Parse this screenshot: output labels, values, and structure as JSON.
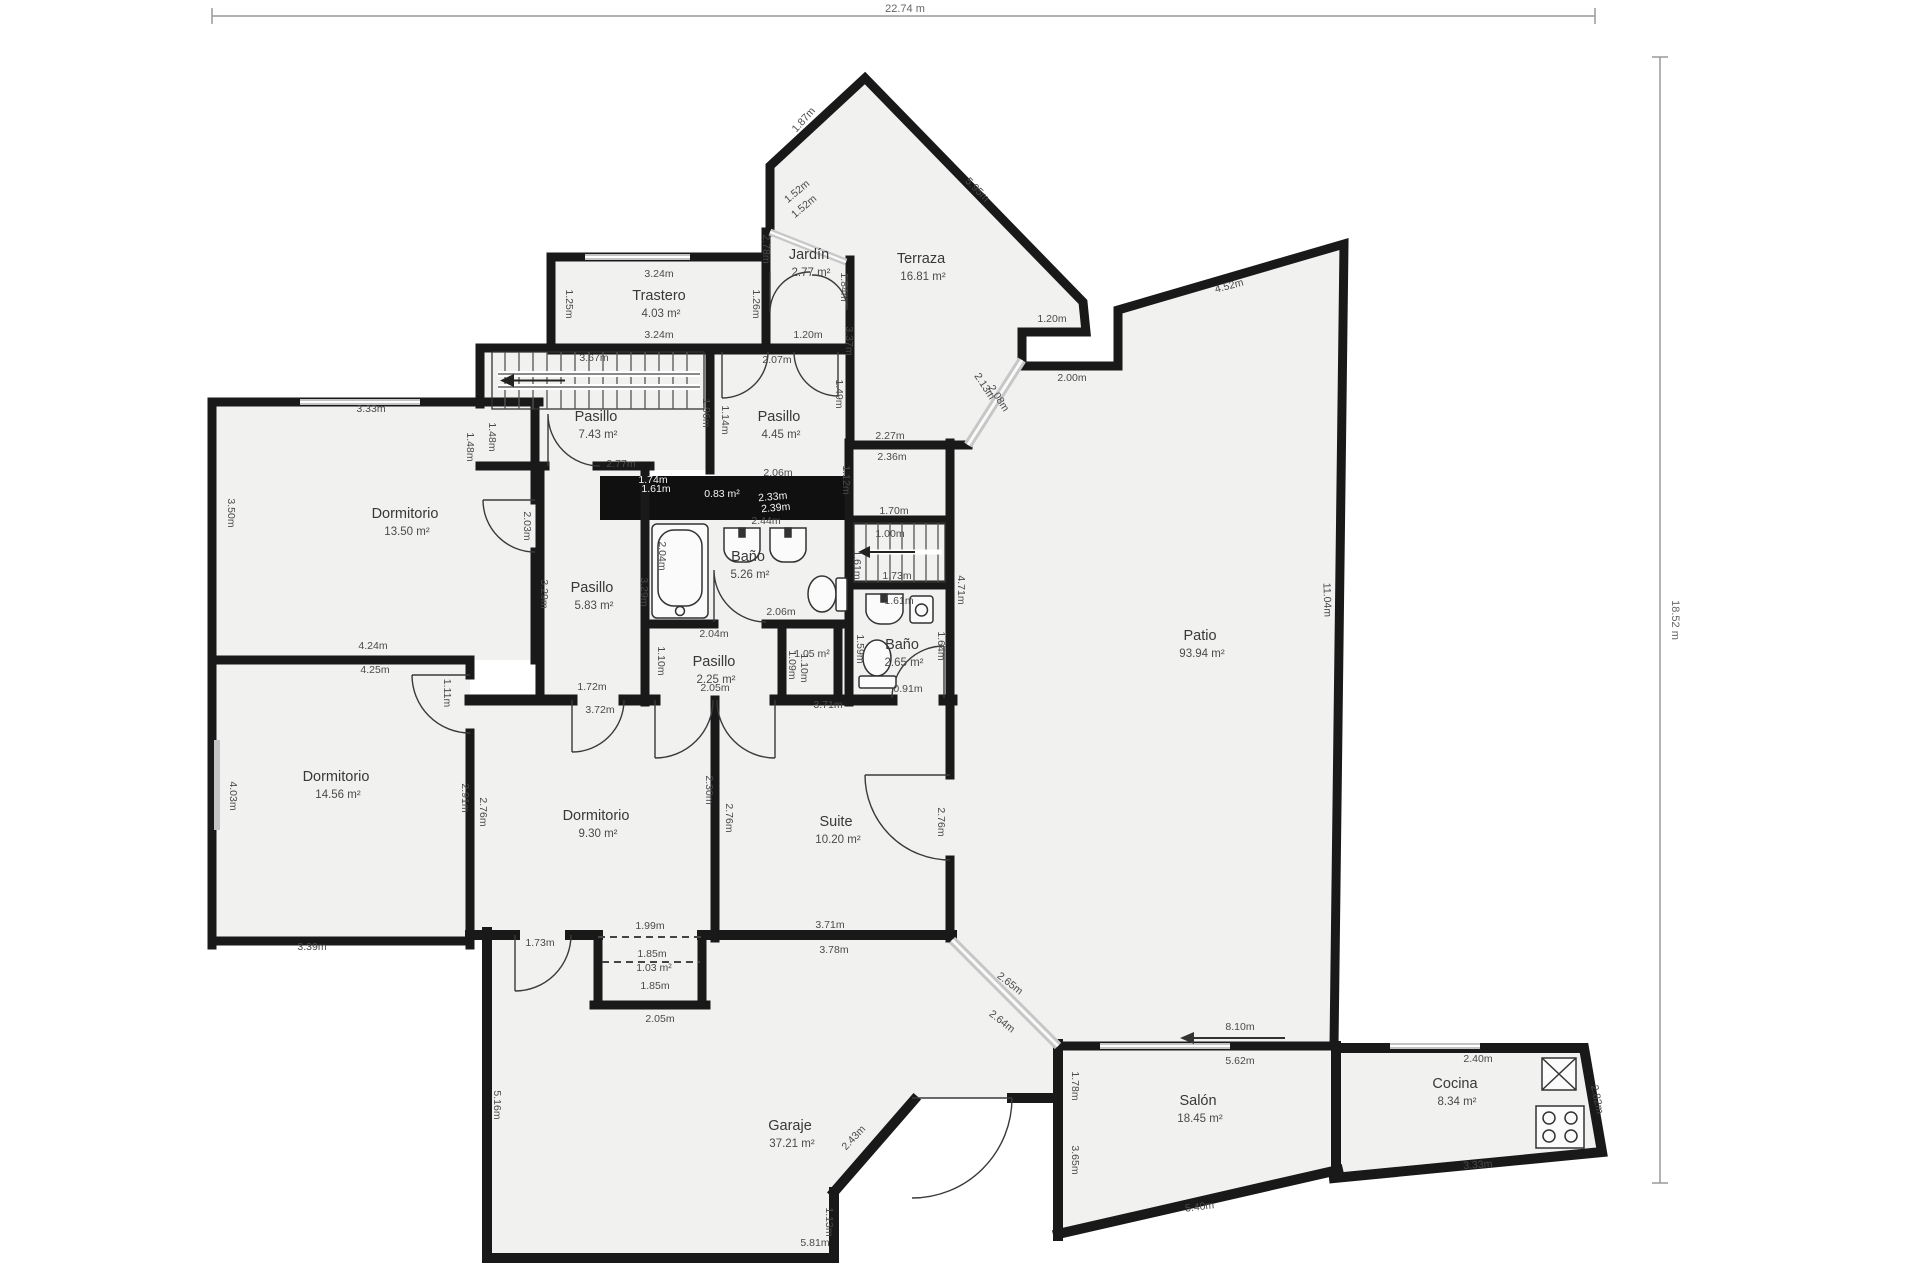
{
  "title": "floor-plan",
  "colors": {
    "wall": "#191919",
    "floor": "#f1f1f0",
    "shaft": "#101010",
    "dim_text": "#4a4a4a",
    "room_text": "#383838",
    "ruler": "#999999"
  },
  "rulers": {
    "width_label": "22.74 m",
    "height_label": "18.52 m"
  },
  "rooms": [
    {
      "name": "Trastero",
      "area": "4.03 m²",
      "x": 659,
      "y": 300
    },
    {
      "name": "Jardín",
      "area": "2.77 m²",
      "x": 809,
      "y": 259
    },
    {
      "name": "Terraza",
      "area": "16.81 m²",
      "x": 921,
      "y": 263
    },
    {
      "name": "Pasillo",
      "area": "7.43 m²",
      "x": 596,
      "y": 421
    },
    {
      "name": "Pasillo",
      "area": "4.45 m²",
      "x": 779,
      "y": 421
    },
    {
      "name": "Dormitorio",
      "area": "13.50 m²",
      "x": 405,
      "y": 518
    },
    {
      "name": "Pasillo",
      "area": "5.83 m²",
      "x": 592,
      "y": 592
    },
    {
      "name": "Baño",
      "area": "5.26 m²",
      "x": 748,
      "y": 561
    },
    {
      "name": "Pasillo",
      "area": "2.25 m²",
      "x": 714,
      "y": 666
    },
    {
      "name": "Baño",
      "area": "2.65 m²",
      "x": 902,
      "y": 649
    },
    {
      "name": "Dormitorio",
      "area": "14.56 m²",
      "x": 336,
      "y": 781
    },
    {
      "name": "Dormitorio",
      "area": "9.30 m²",
      "x": 596,
      "y": 820
    },
    {
      "name": "Suite",
      "area": "10.20 m²",
      "x": 836,
      "y": 826
    },
    {
      "name": "Patio",
      "area": "93.94 m²",
      "x": 1200,
      "y": 640
    },
    {
      "name": "Garaje",
      "area": "37.21 m²",
      "x": 790,
      "y": 1130
    },
    {
      "name": "Salón",
      "area": "18.45 m²",
      "x": 1198,
      "y": 1105
    },
    {
      "name": "Cocina",
      "area": "8.34 m²",
      "x": 1455,
      "y": 1088
    }
  ],
  "dims": [
    {
      "t": "1.87m",
      "x": 806,
      "y": 122,
      "r": -48
    },
    {
      "t": "1.52m",
      "x": 799,
      "y": 194,
      "r": -40
    },
    {
      "t": "1.52m",
      "x": 806,
      "y": 209,
      "r": -40
    },
    {
      "t": "5.95m",
      "x": 975,
      "y": 192,
      "r": 45
    },
    {
      "t": "2.78m",
      "x": 763,
      "y": 249,
      "r": 90
    },
    {
      "t": "1.84m",
      "x": 841,
      "y": 287,
      "r": 90
    },
    {
      "t": "1.20m",
      "x": 808,
      "y": 338
    },
    {
      "t": "3.24m",
      "x": 659,
      "y": 277
    },
    {
      "t": "3.24m",
      "x": 659,
      "y": 338
    },
    {
      "t": "1.25m",
      "x": 566,
      "y": 304,
      "r": 90
    },
    {
      "t": "1.26m",
      "x": 753,
      "y": 304,
      "r": 90
    },
    {
      "t": "2.07m",
      "x": 777,
      "y": 363
    },
    {
      "t": "1.20m",
      "x": 1052,
      "y": 322
    },
    {
      "t": "2.00m",
      "x": 1072,
      "y": 381
    },
    {
      "t": "4.52m",
      "x": 1230,
      "y": 289,
      "r": -15
    },
    {
      "t": "2.13m",
      "x": 982,
      "y": 388,
      "r": 57
    },
    {
      "t": "2.08m",
      "x": 996,
      "y": 400,
      "r": 57
    },
    {
      "t": "2.27m",
      "x": 890,
      "y": 439
    },
    {
      "t": "2.36m",
      "x": 892,
      "y": 460
    },
    {
      "t": "3.37m",
      "x": 846,
      "y": 341,
      "r": 90
    },
    {
      "t": "11.04m",
      "x": 1324,
      "y": 600,
      "r": 88
    },
    {
      "t": "3.67m",
      "x": 594,
      "y": 361
    },
    {
      "t": "1.48m",
      "x": 467,
      "y": 447,
      "r": 90
    },
    {
      "t": "1.48m",
      "x": 489,
      "y": 437,
      "r": 90
    },
    {
      "t": "1.96m",
      "x": 703,
      "y": 413,
      "r": 90
    },
    {
      "t": "1.14m",
      "x": 722,
      "y": 420,
      "r": 90
    },
    {
      "t": "1.49m",
      "x": 836,
      "y": 394,
      "r": 90
    },
    {
      "t": "2.77m",
      "x": 621,
      "y": 467
    },
    {
      "t": "2.06m",
      "x": 778,
      "y": 476
    },
    {
      "t": "3.33m",
      "x": 371,
      "y": 412
    },
    {
      "t": "3.50m",
      "x": 228,
      "y": 513,
      "r": 90
    },
    {
      "t": "2.03m",
      "x": 524,
      "y": 526,
      "r": 90
    },
    {
      "t": "4.24m",
      "x": 373,
      "y": 649
    },
    {
      "t": "4.25m",
      "x": 375,
      "y": 673
    },
    {
      "t": "3.29m",
      "x": 541,
      "y": 594,
      "r": 90
    },
    {
      "t": "3.29m",
      "x": 641,
      "y": 592,
      "r": 90
    },
    {
      "t": "1.72m",
      "x": 592,
      "y": 690
    },
    {
      "t": "3.72m",
      "x": 600,
      "y": 713
    },
    {
      "t": "1.12m",
      "x": 843,
      "y": 480,
      "r": 90
    },
    {
      "t": "1.70m",
      "x": 894,
      "y": 514
    },
    {
      "t": "1.00m",
      "x": 890,
      "y": 537
    },
    {
      "t": "1.73m",
      "x": 897,
      "y": 579
    },
    {
      "t": "2.04m",
      "x": 659,
      "y": 556,
      "r": 90
    },
    {
      "t": "2.44m",
      "x": 766,
      "y": 524,
      "s": 10
    },
    {
      "t": "1.61m",
      "x": 854,
      "y": 565,
      "r": 90,
      "s": 9.5
    },
    {
      "t": "2.06m",
      "x": 781,
      "y": 615
    },
    {
      "t": "2.04m",
      "x": 714,
      "y": 637
    },
    {
      "t": "2.05m",
      "x": 715,
      "y": 691
    },
    {
      "t": "1.10m",
      "x": 658,
      "y": 661,
      "r": 90
    },
    {
      "t": "1.05 m²",
      "x": 812,
      "y": 657,
      "s": 9
    },
    {
      "t": "1.09m",
      "x": 789,
      "y": 665,
      "r": 90,
      "s": 9
    },
    {
      "t": "1.10m",
      "x": 801,
      "y": 668,
      "r": 90,
      "s": 9
    },
    {
      "t": "1.61m",
      "x": 899,
      "y": 604,
      "s": 9
    },
    {
      "t": "1.59m",
      "x": 857,
      "y": 649,
      "r": 90
    },
    {
      "t": "1.64m",
      "x": 938,
      "y": 646,
      "r": 90
    },
    {
      "t": "0.91m",
      "x": 908,
      "y": 692
    },
    {
      "t": "4.03m",
      "x": 230,
      "y": 796,
      "r": 90
    },
    {
      "t": "3.39m",
      "x": 312,
      "y": 950
    },
    {
      "t": "2.91m",
      "x": 462,
      "y": 798,
      "r": 90
    },
    {
      "t": "2.76m",
      "x": 480,
      "y": 812,
      "r": 90
    },
    {
      "t": "1.11m",
      "x": 444,
      "y": 693,
      "r": 90
    },
    {
      "t": "2.30m",
      "x": 706,
      "y": 790,
      "r": 90
    },
    {
      "t": "2.76m",
      "x": 726,
      "y": 818,
      "r": 90
    },
    {
      "t": "2.76m",
      "x": 938,
      "y": 822,
      "r": 90
    },
    {
      "t": "4.71m",
      "x": 958,
      "y": 590,
      "r": 90
    },
    {
      "t": "3.71m",
      "x": 828,
      "y": 708
    },
    {
      "t": "3.71m",
      "x": 830,
      "y": 928
    },
    {
      "t": "3.78m",
      "x": 834,
      "y": 953
    },
    {
      "t": "1.99m",
      "x": 650,
      "y": 929
    },
    {
      "t": "1.85m",
      "x": 652,
      "y": 957,
      "s": 10
    },
    {
      "t": "1.03 m²",
      "x": 654,
      "y": 971,
      "s": 10
    },
    {
      "t": "1.85m",
      "x": 655,
      "y": 989,
      "s": 10
    },
    {
      "t": "2.05m",
      "x": 660,
      "y": 1022
    },
    {
      "t": "1.73m",
      "x": 540,
      "y": 946
    },
    {
      "t": "2.65m",
      "x": 1008,
      "y": 986,
      "r": 38
    },
    {
      "t": "2.64m",
      "x": 1000,
      "y": 1024,
      "r": 38
    },
    {
      "t": "8.10m",
      "x": 1240,
      "y": 1030
    },
    {
      "t": "5.62m",
      "x": 1240,
      "y": 1064
    },
    {
      "t": "1.78m",
      "x": 1072,
      "y": 1086,
      "r": 90
    },
    {
      "t": "3.65m",
      "x": 1072,
      "y": 1160,
      "r": 90
    },
    {
      "t": "5.40m",
      "x": 1200,
      "y": 1210,
      "r": -7
    },
    {
      "t": "2.40m",
      "x": 1478,
      "y": 1062
    },
    {
      "t": "2.82m",
      "x": 1594,
      "y": 1100,
      "r": 78
    },
    {
      "t": "3.33m",
      "x": 1478,
      "y": 1168,
      "r": -4
    },
    {
      "t": "5.81m",
      "x": 815,
      "y": 1246
    },
    {
      "t": "5.16m",
      "x": 494,
      "y": 1105,
      "r": 90
    },
    {
      "t": "1.13m",
      "x": 826,
      "y": 1222,
      "r": 90
    },
    {
      "t": "2.43m",
      "x": 856,
      "y": 1140,
      "r": -47
    },
    {
      "t": "0.83 m²",
      "x": 722,
      "y": 497,
      "w": 1,
      "s": 11
    },
    {
      "t": "2.33m",
      "x": 773,
      "y": 500,
      "r": -5,
      "w": 1,
      "s": 10
    },
    {
      "t": "2.39m",
      "x": 776,
      "y": 511,
      "r": -5,
      "w": 1,
      "s": 10
    },
    {
      "t": "1.74m",
      "x": 653,
      "y": 483,
      "w": 1,
      "s": 8.5
    },
    {
      "t": "1.61m",
      "x": 656,
      "y": 492,
      "w": 1,
      "s": 8.5
    }
  ]
}
